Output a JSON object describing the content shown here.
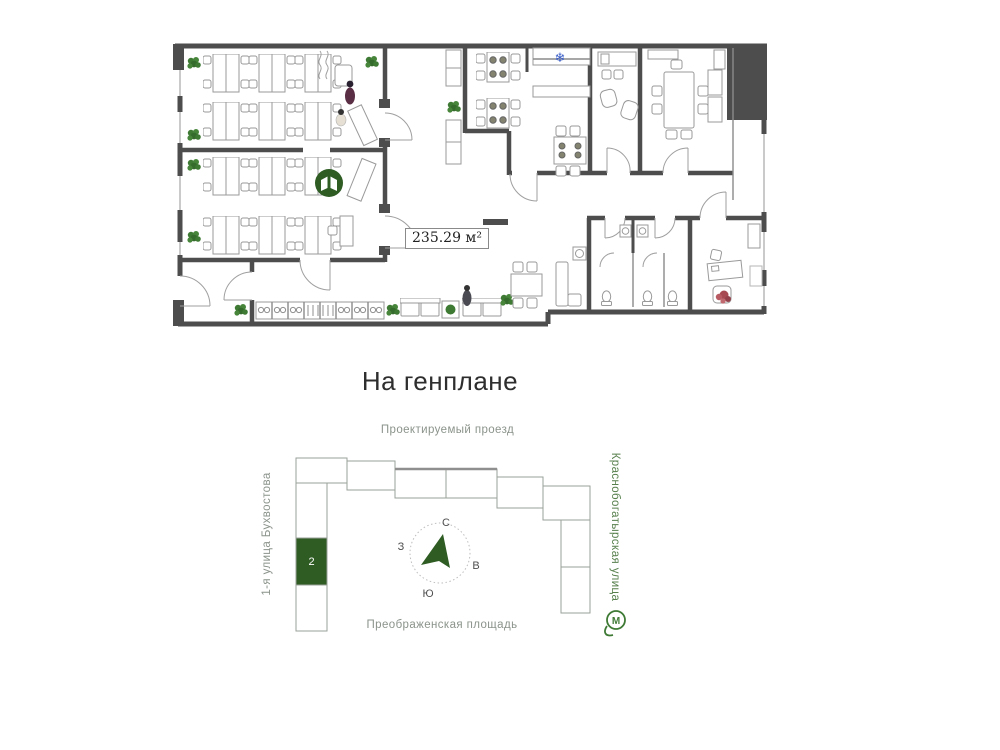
{
  "floor_plan": {
    "area_label": "235.29 м²",
    "icons": {
      "library": "book-icon",
      "cooler": "snowflake-icon",
      "snowflake_glyph": "❄"
    }
  },
  "site_plan": {
    "title": "На генплане",
    "streets": {
      "top": "Проектируемый проезд",
      "bottom": "Преображенская площадь",
      "left": "1-я улица Бухвостова",
      "right": "Краснобогатырская улица"
    },
    "compass": {
      "north": "С",
      "south": "Ю",
      "west": "З",
      "east": "В"
    },
    "highlighted_building_number": "2",
    "metro_label": "М"
  },
  "colors": {
    "accent_green": "#2e5c23",
    "plant_green": "#3e7a33",
    "wall_gray": "#4d4d4d",
    "street_gray": "#8b938b",
    "street_green": "#57804d",
    "snowflake_blue": "#3a5fc8",
    "person_red": "#a84a52"
  }
}
